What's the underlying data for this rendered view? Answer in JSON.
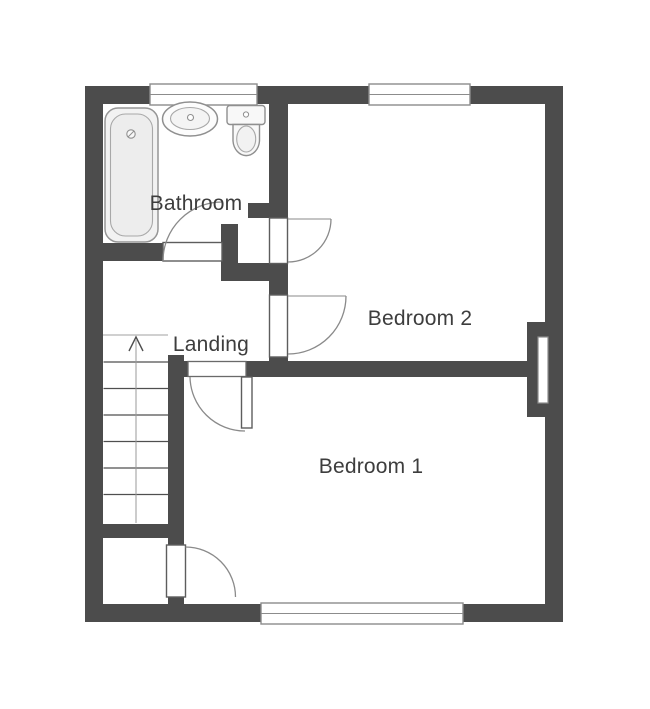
{
  "title": "Floor plan",
  "rooms": [
    {
      "id": "bathroom",
      "label": "Bathroom"
    },
    {
      "id": "landing",
      "label": "Landing"
    },
    {
      "id": "bedroom-2",
      "label": "Bedroom 2"
    },
    {
      "id": "bedroom-1",
      "label": "Bedroom 1"
    }
  ],
  "fixtures": [
    "bathtub",
    "washbasin",
    "toilet",
    "staircase"
  ],
  "stairs": {
    "direction": "up",
    "visible_steps": 7
  },
  "openings": {
    "windows": 3,
    "doors": 5,
    "wall_recess": 1
  },
  "colors": {
    "wall": "#4c4c4c",
    "background": "#ffffff",
    "fixture_outline": "#8f8f8f",
    "window_outline": "#8c8c8c",
    "label_text": "#3d3d3d"
  }
}
